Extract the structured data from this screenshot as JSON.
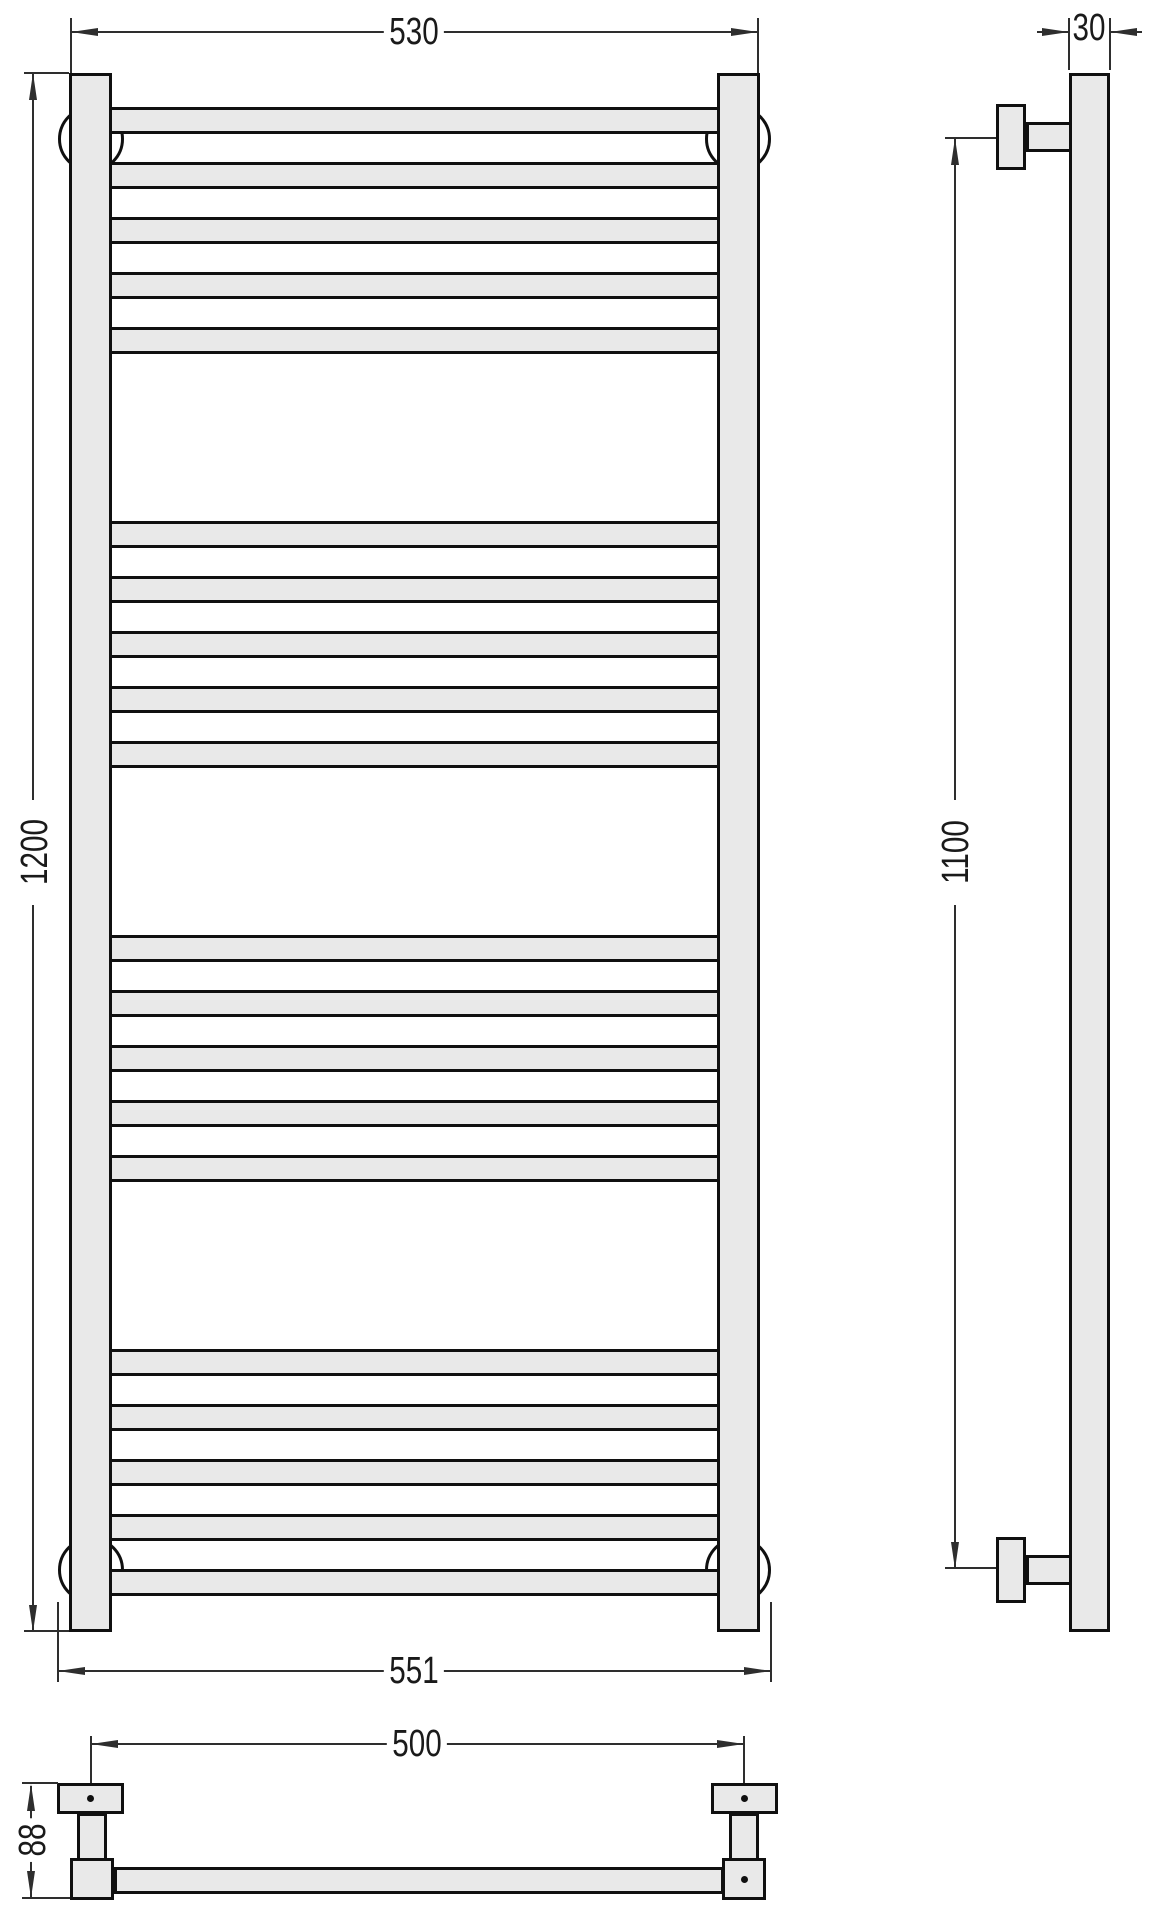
{
  "drawing": {
    "type": "technical-drawing",
    "subject": "ladder-style heated towel rail, three orthographic views with dimensions",
    "units_shown": "numbers only (no unit text visible)",
    "colors": {
      "fill": "#e9e9e9",
      "line": "#101010",
      "dim": "#2e2e2e",
      "text": "#1a1a1a",
      "background": "#ffffff"
    },
    "dimensions": {
      "top_width": "530",
      "overall_height": "1200",
      "bottom_width": "551",
      "pipe_depth": "30",
      "mount_spacing_height": "1100",
      "bracket_spacing_width": "500",
      "bracket_depth": "88"
    },
    "front_view": {
      "description": "ladder with two vertical rails, 4 groups of horizontal rungs, 4 round wall-mount bosses",
      "rung_groups": [
        5,
        5,
        5,
        5
      ],
      "rung_total": 20
    },
    "side_view": {
      "description": "single vertical pipe with two wall brackets (top and bottom)"
    },
    "bottom_view": {
      "description": "horizontal pipe with two wall brackets, screw dots on bracket plates and right pipe end"
    }
  }
}
